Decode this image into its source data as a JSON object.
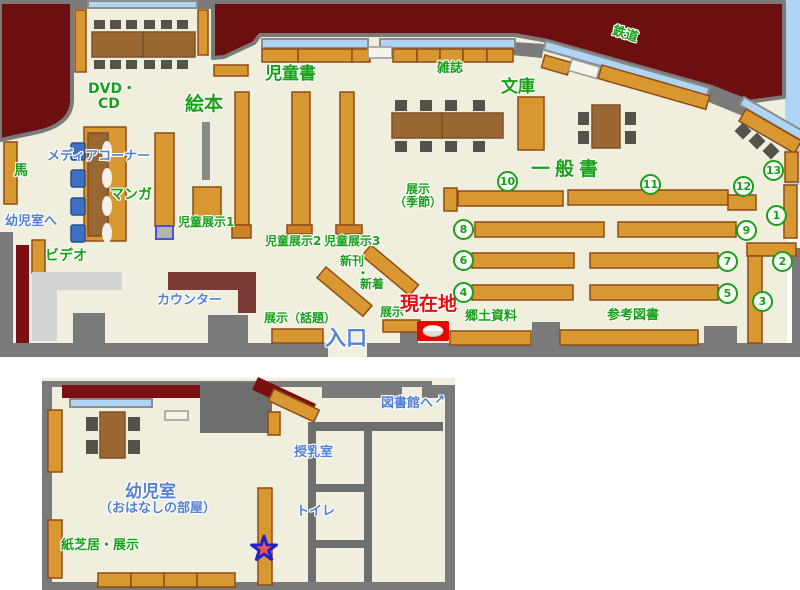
{
  "colors": {
    "floor": "#f0eedd",
    "exterior": "#6d0e10",
    "wall_gray": "#7a7a7a",
    "shelf_orange": "#d99732",
    "table_brown": "#9a6733",
    "window_blue": "#aed6f4",
    "label_green": "#18a018",
    "label_blue": "#5580d8",
    "marker_red": "#ee0000",
    "counter_darkred": "#7b3b36"
  },
  "main_floor": {
    "areas": {
      "ehon": "絵本",
      "jidosho": "児童書",
      "zasshi": "雑誌",
      "bunko": "文庫",
      "tetsudo": "鉄道",
      "ippansho": "一般書",
      "dvd_line1": "DVD・",
      "dvd_line2": "CD",
      "media_corner": "メディアコーナー",
      "manga": "マンガ",
      "uma": "馬",
      "video": "ビデオ",
      "kyodo_shiryo": "郷土資料",
      "sanko_tosho": "参考図書"
    },
    "displays": {
      "jido_tenji1": "児童展示1",
      "jido_tenji2": "児童展示2",
      "jido_tenji3": "児童展示3",
      "tenji_kisetsu_line1": "展示",
      "tenji_kisetsu_line2": "（季節）",
      "shinkan_line1": "新刊",
      "shinkan_dot": "・",
      "shinkan_line2": "新着",
      "tenji_wadai": "展示（話題）",
      "tenji_front": "展示"
    },
    "points": {
      "genzaichi": "現在地",
      "iriguchi": "入口",
      "counter": "カウンター",
      "yojishitsu_e": "幼児室へ"
    },
    "shelf_numbers": [
      "1",
      "2",
      "3",
      "4",
      "5",
      "6",
      "7",
      "8",
      "9",
      "10",
      "11",
      "12",
      "13"
    ]
  },
  "kids_room": {
    "yojishitsu": "幼児室",
    "ohanashi": "（おはなしの部屋）",
    "kamishibai": "紙芝居・展示",
    "junyushitsu": "授乳室",
    "toire": "トイレ",
    "toshokan_e": "図書館へ",
    "arrow": "↗"
  }
}
